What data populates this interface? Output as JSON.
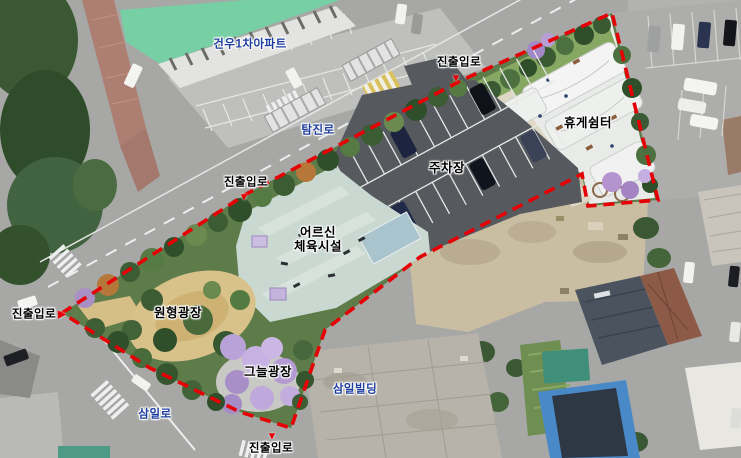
{
  "map": {
    "title": "park development aerial site plan",
    "boundary_color": "#e60005",
    "label_color_blue": "#1d3d9e",
    "label_color_black": "#000000",
    "labels": {
      "apartment": "건우1차아파트",
      "road_tamjin": "탐진로",
      "road_samil": "삼일로",
      "building_samil": "삼일빌딩",
      "access_road": "진출입로",
      "rest_shelter": "휴게쉼터",
      "parking_lot": "주차장",
      "senior_facility_line1": "어르신",
      "senior_facility_line2": "체육시설",
      "circular_plaza": "원형광장",
      "shade_plaza": "그늘광장"
    },
    "markers": {
      "arrow_down": "▼",
      "arrow_right": "▶"
    }
  }
}
